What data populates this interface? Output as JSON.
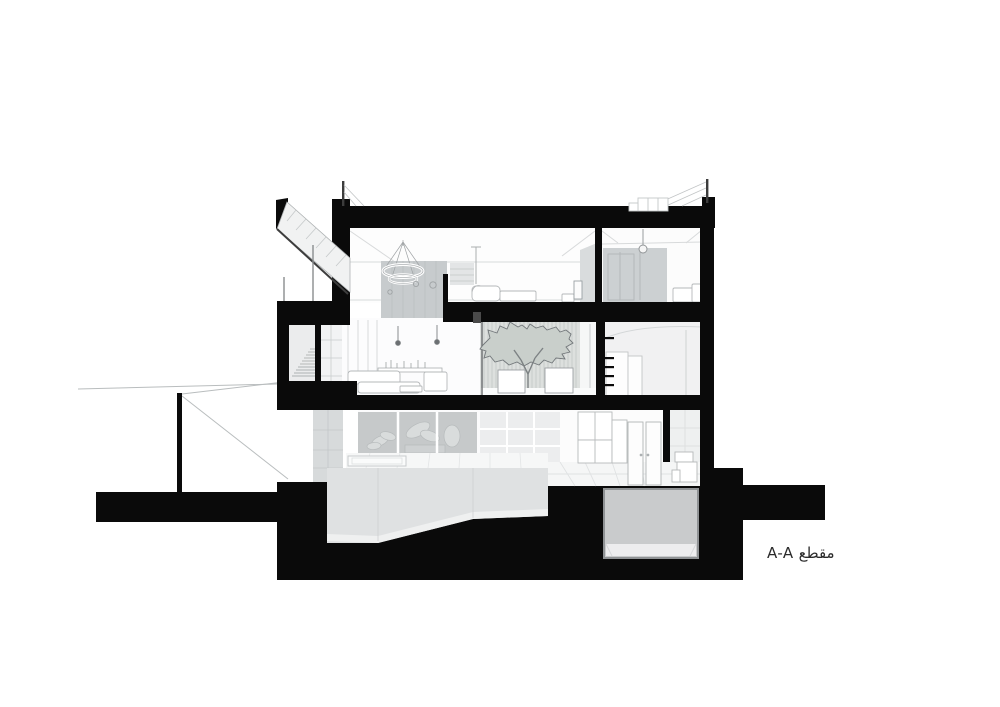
{
  "annotation": {
    "section_label": "A-A مقطع"
  },
  "palette": {
    "poche": "#0a0a0a",
    "paper": "#ffffff",
    "wall_accent": "#c7cbcd",
    "wall_soft": "#d9dcdd",
    "glass_gray": "#d7dadb",
    "band_gray": "#c6c9ca",
    "tile_gray": "#ecedee",
    "room_gray": "#f1f1f2",
    "stripe_bg": "#dde0de",
    "stripe_line": "#c2c6c4",
    "tree_gray": "#c9cfcb",
    "tree_line": "#72777a",
    "pool_gray": "#dfe1e2",
    "pool_floor": "#eff0f0",
    "deck_white": "#f6f7f7",
    "basement_fill": "#c9cbcc",
    "basement_floor": "#ededee",
    "basement_stroke": "#8f9294",
    "line_light": "#d8dadb",
    "line_mid": "#b9bdbe",
    "line_dark": "#8a8d8e",
    "label_color": "#2b2b2b"
  }
}
